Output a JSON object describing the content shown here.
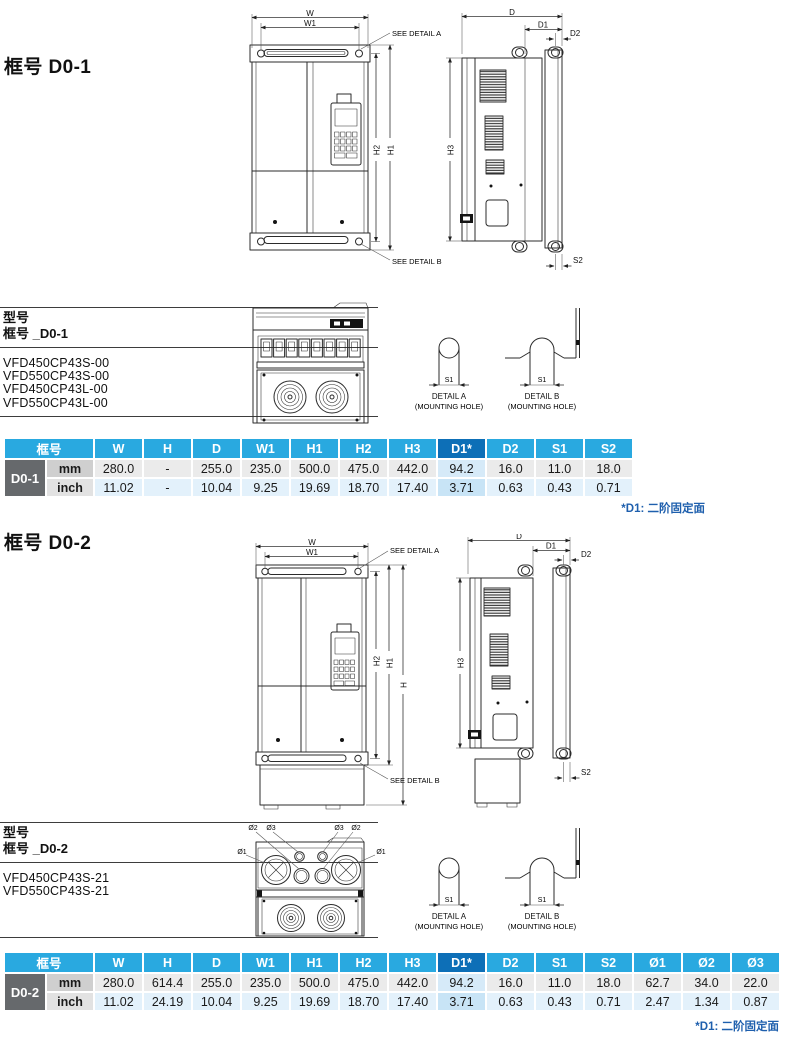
{
  "colors": {
    "header_bg": "#29A9E0",
    "header_highlight_bg": "#0D6FB7",
    "frame_cell_bg": "#66696C",
    "unit_mm_bg": "#CFCFCF",
    "unit_inch_bg": "#E2E2E2",
    "row_mm_bg": "#EBEBEB",
    "row_inch_bg": "#E3F1FB",
    "d1_mm_bg": "#D6EAF8",
    "d1_inch_bg": "#C8E4F6",
    "note_color": "#1E5FAD"
  },
  "d01": {
    "heading": "框号 D0-1",
    "front": {
      "w": "W",
      "w1": "W1",
      "h1": "H1",
      "h2": "H2",
      "see_a": "SEE DETAIL A",
      "see_b": "SEE DETAIL B"
    },
    "side": {
      "d": "D",
      "d1": "D1",
      "d2": "D2",
      "h3": "H3",
      "s2": "S2"
    },
    "models_title": "型号",
    "models_subtitle": "框号 _D0-1",
    "models": [
      "VFD450CP43S-00",
      "VFD550CP43S-00",
      "VFD450CP43L-00",
      "VFD550CP43L-00"
    ],
    "detail_a": {
      "s1": "S1",
      "title": "DETAIL A",
      "subtitle": "(MOUNTING HOLE)"
    },
    "detail_b": {
      "s1": "S1",
      "title": "DETAIL B",
      "subtitle": "(MOUNTING HOLE)"
    },
    "table": {
      "frame_header": "框号",
      "frame": "D0-1",
      "columns": [
        "W",
        "H",
        "D",
        "W1",
        "H1",
        "H2",
        "H3",
        "D1*",
        "D2",
        "S1",
        "S2"
      ],
      "mm_label": "mm",
      "inch_label": "inch",
      "mm": [
        "280.0",
        "-",
        "255.0",
        "235.0",
        "500.0",
        "475.0",
        "442.0",
        "94.2",
        "16.0",
        "11.0",
        "18.0"
      ],
      "inch": [
        "11.02",
        "-",
        "10.04",
        "9.25",
        "19.69",
        "18.70",
        "17.40",
        "3.71",
        "0.63",
        "0.43",
        "0.71"
      ],
      "note": "*D1: 二阶固定面"
    }
  },
  "d02": {
    "heading": "框号 D0-2",
    "front": {
      "w": "W",
      "w1": "W1",
      "h": "H",
      "h1": "H1",
      "h2": "H2",
      "see_a": "SEE DETAIL A",
      "see_b": "SEE DETAIL B"
    },
    "side": {
      "d": "D",
      "d1": "D1",
      "d2": "D2",
      "h3": "H3",
      "s2": "S2"
    },
    "bottom": {
      "o1": "Ø1",
      "o2": "Ø2",
      "o3": "Ø3"
    },
    "models_title": "型号",
    "models_subtitle": "框号 _D0-2",
    "models": [
      "VFD450CP43S-21",
      "VFD550CP43S-21"
    ],
    "detail_a": {
      "s1": "S1",
      "title": "DETAIL A",
      "subtitle": "(MOUNTING HOLE)"
    },
    "detail_b": {
      "s1": "S1",
      "title": "DETAIL B",
      "subtitle": "(MOUNTING HOLE)"
    },
    "table": {
      "frame_header": "框号",
      "frame": "D0-2",
      "columns": [
        "W",
        "H",
        "D",
        "W1",
        "H1",
        "H2",
        "H3",
        "D1*",
        "D2",
        "S1",
        "S2",
        "Ø1",
        "Ø2",
        "Ø3"
      ],
      "mm_label": "mm",
      "inch_label": "inch",
      "mm": [
        "280.0",
        "614.4",
        "255.0",
        "235.0",
        "500.0",
        "475.0",
        "442.0",
        "94.2",
        "16.0",
        "11.0",
        "18.0",
        "62.7",
        "34.0",
        "22.0"
      ],
      "inch": [
        "11.02",
        "24.19",
        "10.04",
        "9.25",
        "19.69",
        "18.70",
        "17.40",
        "3.71",
        "0.63",
        "0.43",
        "0.71",
        "2.47",
        "1.34",
        "0.87"
      ],
      "note": "*D1: 二阶固定面"
    }
  }
}
